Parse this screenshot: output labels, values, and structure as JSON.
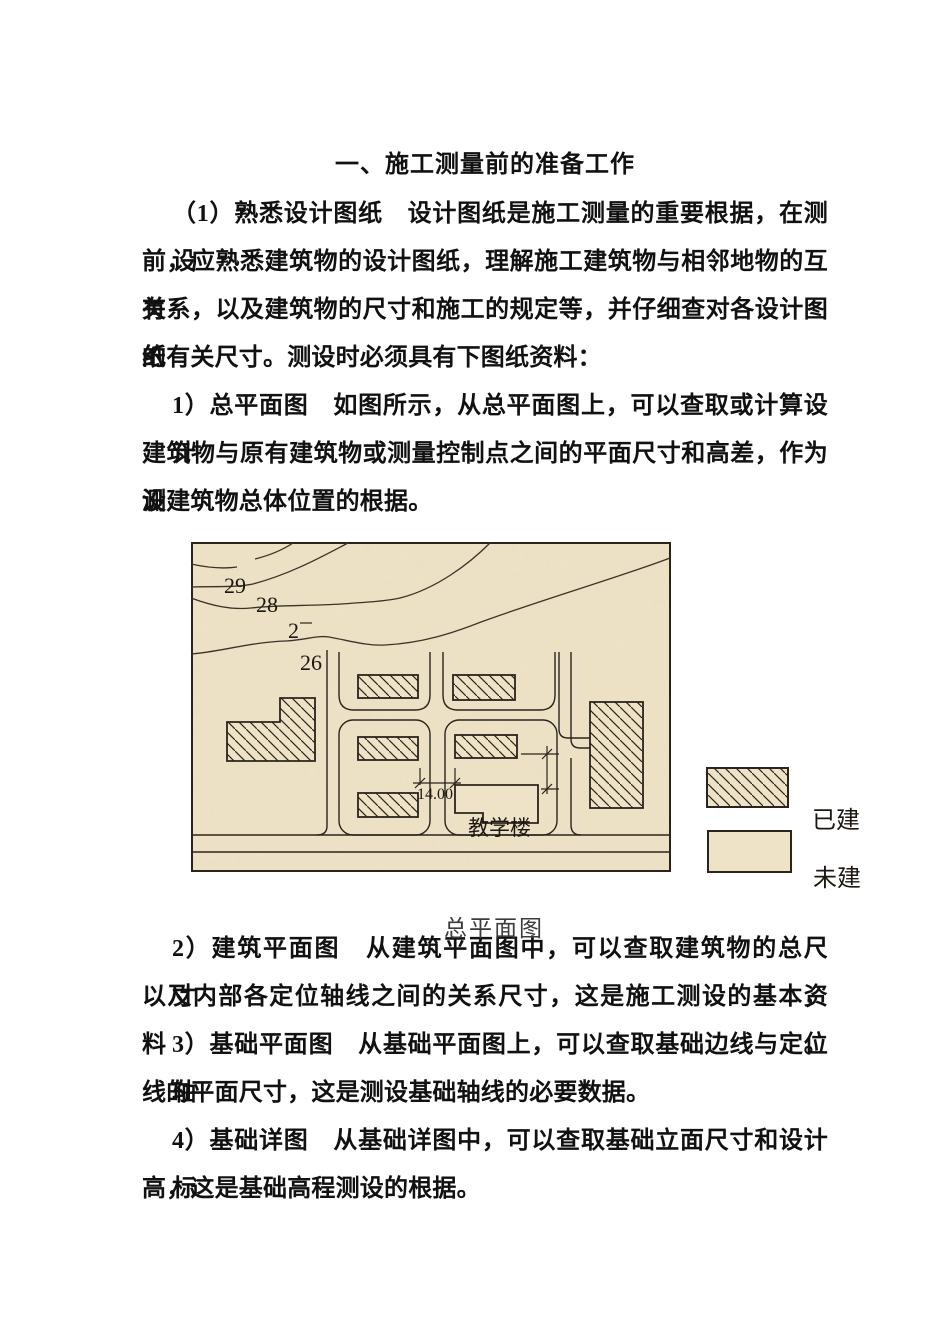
{
  "page": {
    "title": "一、施工测量前的准备工作",
    "paragraphs": [
      {
        "lines": [
          "（1）熟悉设计图纸　设计图纸是施工测量的重要根据，在测设",
          "前，应熟悉建筑物的设计图纸，理解施工建筑物与相邻地物的互有",
          "关系，以及建筑物的尺寸和施工的规定等，并仔细查对各设计图纸",
          "的有关尺寸。测设时必须具有下图纸资料："
        ]
      },
      {
        "lines": [
          "1）总平面图　如图所示，从总平面图上，可以查取或计算设计",
          "建筑物与原有建筑物或测量控制点之间的平面尺寸和高差，作为测",
          "设建筑物总体位置的根据。"
        ]
      },
      {
        "lines": [
          "2）建筑平面图　从建筑平面图中，可以查取建筑物的总尺寸，",
          "以及内部各定位轴线之间的关系尺寸，这是施工测设的基本资料。"
        ]
      },
      {
        "lines": [
          "3）基础平面图　从基础平面图上，可以查取基础边线与定位轴",
          "线的平面尺寸，这是测设基础轴线的必要数据。"
        ]
      },
      {
        "lines": [
          "4）基础详图　从基础详图中，可以查取基础立面尺寸和设计标",
          "高，这是基础高程测设的根据。"
        ]
      }
    ]
  },
  "figure": {
    "caption": "总平面图",
    "contour_labels": {
      "l1": "29",
      "l2": "28",
      "l3": "2",
      "l4": "26"
    },
    "dimension_label": "14.00",
    "building_label": "教学楼",
    "legend": {
      "built": "已建",
      "unbuilt": "未建"
    },
    "colors": {
      "map_bg": "#eee3c6",
      "ink": "#2b241c"
    }
  }
}
